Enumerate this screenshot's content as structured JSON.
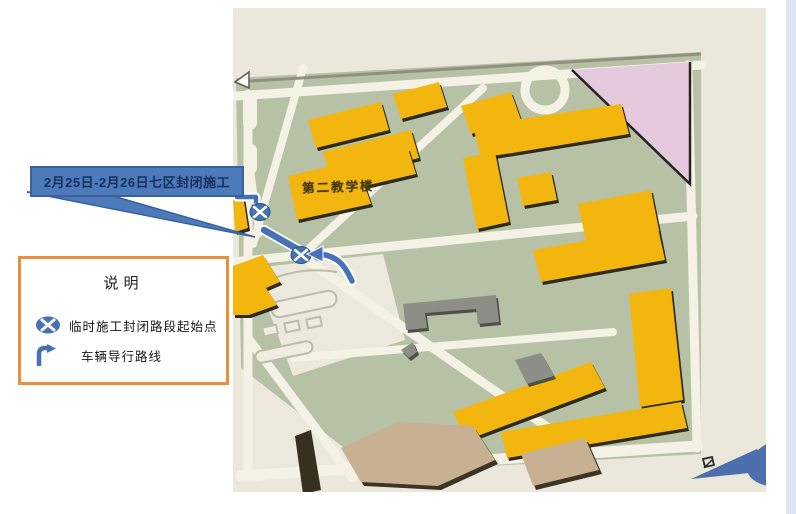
{
  "callout": {
    "text": "2月25日-2月26日七区封闭施工"
  },
  "legend": {
    "title": "说明",
    "items": [
      {
        "icon": "closure-point-icon",
        "label": "临时施工封闭路段起始点"
      },
      {
        "icon": "diversion-route-icon",
        "label": "车辆导行路线"
      }
    ]
  },
  "map": {
    "building_label": "第二教学楼"
  },
  "colors": {
    "annotation_blue": "#4472b4",
    "callout_fill": "#4d7ab9",
    "callout_text": "#14305f",
    "legend_border_orange": "#e8913c",
    "building_yellow": "#f4b60a",
    "map_green": "#b6c1a4",
    "pink_area": "#e6cade",
    "road_beige": "#ebe8db"
  }
}
